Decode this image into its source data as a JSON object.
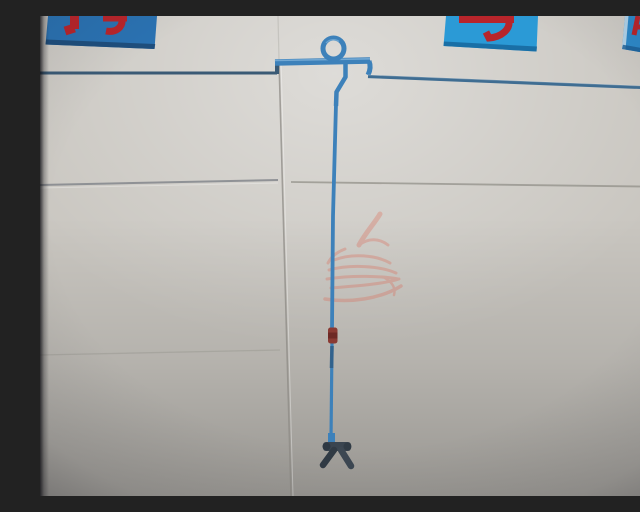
{
  "photo": {
    "kind": "photograph",
    "subject": "Blue water pipe mounted on a white paneled wall: horizontal run with expansion loop at top, long vertical drop with small red inline valve, dark Y-shaped nozzle fitting at bottom end",
    "watermark": "faint red dragon logo watermark near center of frame"
  },
  "signs": {
    "left": {
      "description": "blue sign, bottoms of two red characters visible, cropped by top of frame"
    },
    "middle": {
      "description": "blue sign, bottom of one red character visible, cropped by top of frame"
    },
    "right": {
      "description": "blue sign, bottoms of red characters visible, cropped at top-right corner"
    }
  },
  "colors": {
    "wall_base": "#c9c6c0",
    "pipe_blue": "#3d81ba",
    "pipe_highlight": "#7fb2d9",
    "pipe_thin_left": "#3a5a75",
    "pipe_thin_right": "#3f6d92",
    "pipe_joint_dark": "#2f5d85",
    "sign_blue_left": "#2a72b2",
    "sign_blue_middle": "#2b9ad6",
    "sign_blue_right": "#2d88c8",
    "sign_edge_dark_left": "#1d4a77",
    "sign_edge_dark_middle": "#16679e",
    "sign_edge_dark_right": "#1a5d94",
    "sign_edge_light": "#cfe3f0",
    "glyph_red": "#b8252b",
    "valve_red": "#8a3a33",
    "valve_red_dark": "#6a2823",
    "fixture_dark": "#3a4550",
    "fixture_cap_end": "#2e3842",
    "fixture_leg_left": "#303a44",
    "fixture_leg_right": "#3c4752",
    "watermark_red": "#dd6450",
    "seam": "#8d8b85",
    "seam_horizontal": "#7e8288"
  }
}
